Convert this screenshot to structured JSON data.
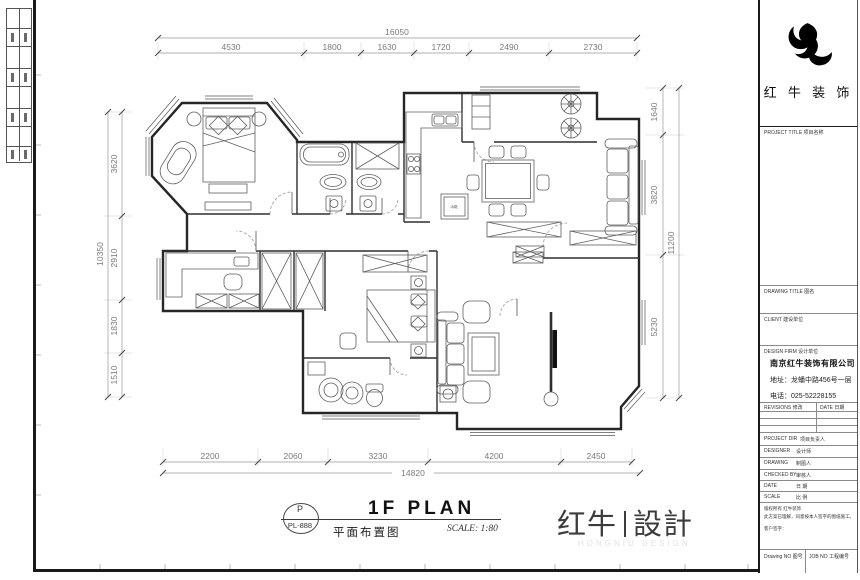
{
  "drawing": {
    "stamp_letter": "P",
    "stamp_code": "PL-888",
    "title_en": "1F PLAN",
    "title_cn": "平面布置图",
    "scale": "SCALE: 1:80",
    "fridge_label": "冰箱"
  },
  "brand": {
    "left": "红牛",
    "right": "設計",
    "sub": "HONGNIU DESIGN"
  },
  "dimensions": {
    "top": {
      "total": "16050",
      "segments": [
        "4530",
        "1800",
        "1630",
        "1720",
        "2490",
        "2730"
      ]
    },
    "left": {
      "total": "10350",
      "segments": [
        "3620",
        "2910",
        "1830",
        "1510"
      ]
    },
    "right": {
      "total": "11200",
      "segments": [
        "1640",
        "3820",
        "5230"
      ]
    },
    "bottom": {
      "total": "14820",
      "segments": [
        "2200",
        "2060",
        "3230",
        "4200",
        "2450"
      ]
    }
  },
  "title_block": {
    "company_logo_text": "红 牛 装 饰",
    "sections": {
      "project_title": "PROJECT TITLE  项目名称",
      "drawing_title": "DRAWING TITLE  图名",
      "client": "CLIENT  建设单位",
      "design_firm": "DESIGN FIRM  设计单位"
    },
    "company": {
      "name": "南京红牛装饰有限公司",
      "address": "地址：龙蟠中路456号一层",
      "phone": "电话：025-52228155"
    },
    "revisions": {
      "col1": "REVISIONS 修改",
      "col2": "DATE 日期"
    },
    "fields": [
      {
        "en": "PROJECT DIR",
        "cn": "项目负责人"
      },
      {
        "en": "DESIGNER",
        "cn": "设计师"
      },
      {
        "en": "DRAWING",
        "cn": "制图人"
      },
      {
        "en": "CHECKED BY",
        "cn": "审核人"
      },
      {
        "en": "DATE",
        "cn": "日  期"
      },
      {
        "en": "SCALE",
        "cn": "比  例"
      }
    ],
    "notes": [
      "版权所有 红牛装饰",
      "此方案已理解，同意按本人签字的图纸施工。",
      "客户签字："
    ],
    "footer": {
      "left": "Drawing NO 图号",
      "right": "JOB NO 工程编号"
    }
  }
}
